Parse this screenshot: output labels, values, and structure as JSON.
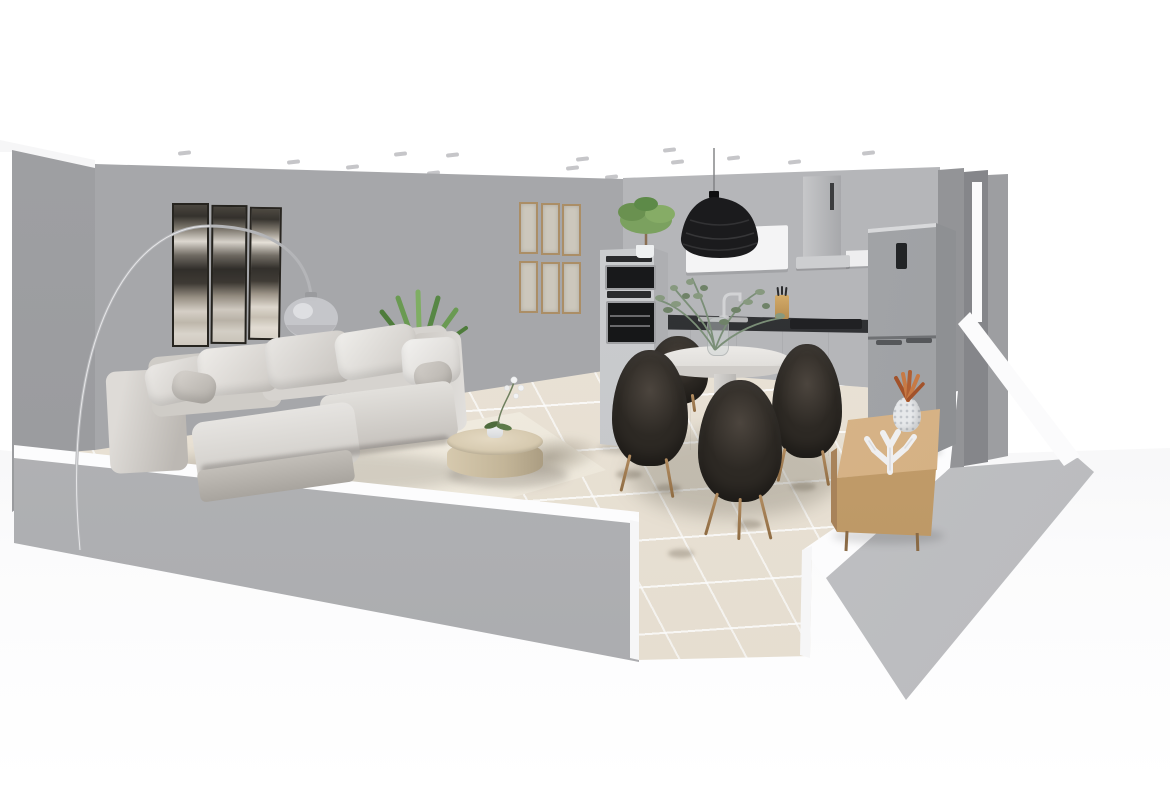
{
  "viewport": {
    "kind": "3d-room-planner-render",
    "width": 1170,
    "height": 785,
    "description": "Cutaway 3D render of an open-plan apartment: living room with sectional sofa at left, round dining table with four dark armchairs in the center, fitted kitchen along the back wall, wooden sideboard against the right wall, beige tiled floor, gray walls with white cut tops, white ceiling with recessed spotlights"
  },
  "colors": {
    "wall": "#a6a7aa",
    "kitchen_wall": "#b5b6b9",
    "wall_cut": "#fcfcfd",
    "floor_tile": "#e9e1d3",
    "rug": "#f2ede1",
    "sofa": "#d6d3cf",
    "chair": "#2d2924",
    "wood": "#d0ab7d",
    "counter": "#3a3b3e",
    "pendant": "#1b1b1d",
    "plant": "#6a9a52",
    "copper": "#b05f33"
  },
  "ceiling_spots": [
    [
      178,
      151
    ],
    [
      287,
      160
    ],
    [
      346,
      165
    ],
    [
      394,
      152
    ],
    [
      427,
      171
    ],
    [
      446,
      153
    ],
    [
      474,
      178
    ],
    [
      531,
      180
    ],
    [
      566,
      166
    ],
    [
      576,
      157
    ],
    [
      605,
      175
    ],
    [
      663,
      148
    ],
    [
      671,
      160
    ],
    [
      727,
      156
    ],
    [
      788,
      160
    ],
    [
      862,
      151
    ]
  ],
  "floor_smudges": [
    [
      655,
      484
    ],
    [
      790,
      482
    ],
    [
      668,
      549
    ],
    [
      616,
      470
    ],
    [
      736,
      520
    ]
  ],
  "objects": {
    "living_room": [
      {
        "name": "triptych-wall-art",
        "label": "black & white abstract triptych"
      },
      {
        "name": "frame-gallery",
        "label": "six thin wooden frames, 2 rows of 3"
      },
      {
        "name": "arc-floor-lamp",
        "label": "chrome arc lamp with glass globe shade"
      },
      {
        "name": "yucca-plant",
        "label": "green spiky plant behind sofa"
      },
      {
        "name": "sectional-sofa",
        "label": "light gray sectional sofa with chaise and pillows"
      },
      {
        "name": "area-rug",
        "label": "cream rug with brown fringe"
      },
      {
        "name": "coffee-table",
        "label": "round travertine drum coffee table"
      },
      {
        "name": "orchid",
        "label": "white potted orchid"
      }
    ],
    "kitchen": [
      {
        "name": "oven-tower",
        "label": "tall cabinet with microwave and oven, plant on top"
      },
      {
        "name": "counter-run",
        "label": "light gray base cabinets with dark countertop"
      },
      {
        "name": "sink-faucet",
        "label": "chrome faucet and sink"
      },
      {
        "name": "knife-block",
        "label": "wooden knife block"
      },
      {
        "name": "cooktop",
        "label": "black cooktop"
      },
      {
        "name": "wall-cabinet",
        "label": "white wall cabinet"
      },
      {
        "name": "range-hood",
        "label": "stainless chimney hood"
      },
      {
        "name": "pendant-light",
        "label": "black woven pendant lamp"
      },
      {
        "name": "fridge",
        "label": "freestanding gray fridge-freezer"
      }
    ],
    "dining": [
      {
        "name": "dining-table",
        "label": "round white pedestal table"
      },
      {
        "name": "dining-chairs",
        "label": "four dark brown armchairs with wooden legs"
      },
      {
        "name": "vase-eucalyptus",
        "label": "glass vase with eucalyptus stems"
      }
    ],
    "right_side": [
      {
        "name": "sideboard",
        "label": "light oak sideboard"
      },
      {
        "name": "pineapple-decor",
        "label": "white ceramic pineapple with copper leaves"
      },
      {
        "name": "coral-decor",
        "label": "white coral sculpture"
      }
    ]
  }
}
